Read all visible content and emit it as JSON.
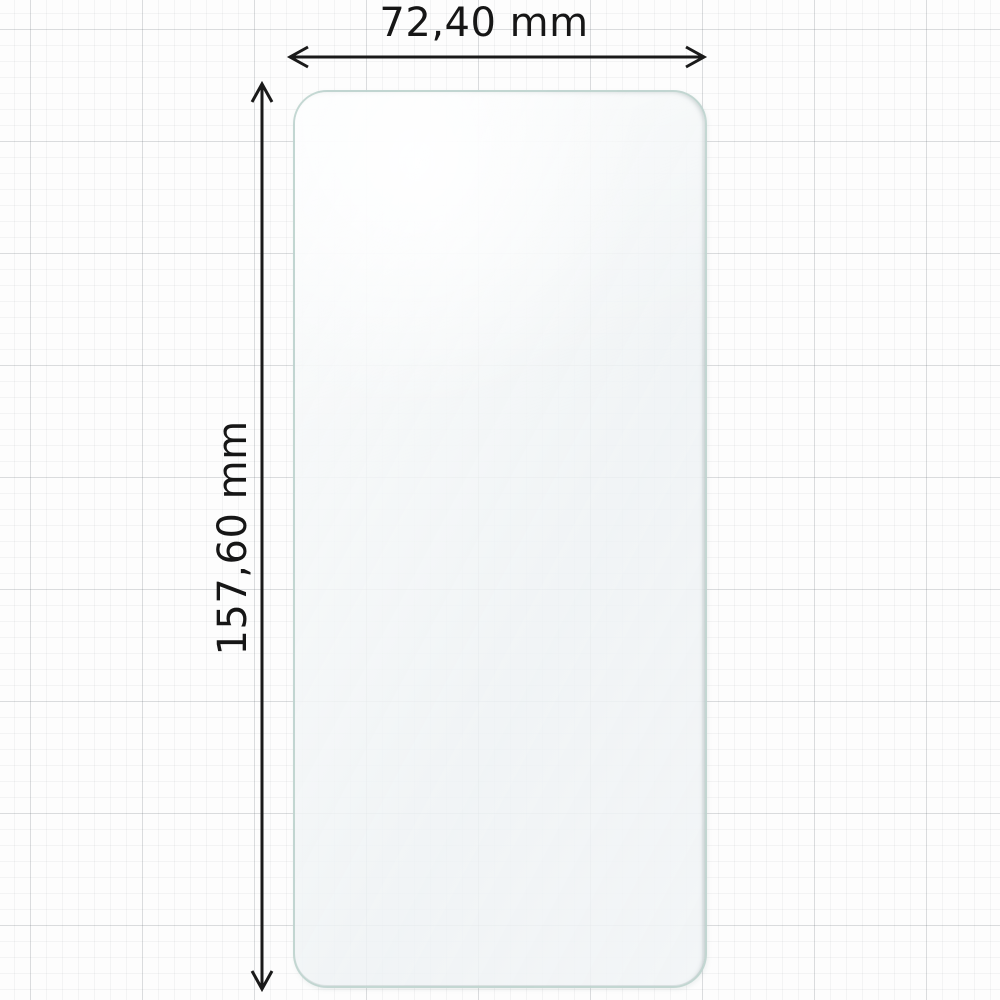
{
  "diagram": {
    "kind": "screen-protector-dimension-diagram",
    "dimensions": {
      "width": {
        "label": "72,40 mm",
        "value": "72,40",
        "unit": "mm"
      },
      "height": {
        "label": "157,60 mm",
        "value": "157,60",
        "unit": "mm"
      }
    },
    "colors": {
      "background": "#fdfdfd",
      "grid_minor": "#ebecee",
      "grid_major": "#d4d7da",
      "dimension_line": "#1a1a1a",
      "label_text": "#161616",
      "protector_edge": "#a8c4bd",
      "protector_fill": "#f0f3f5"
    }
  }
}
